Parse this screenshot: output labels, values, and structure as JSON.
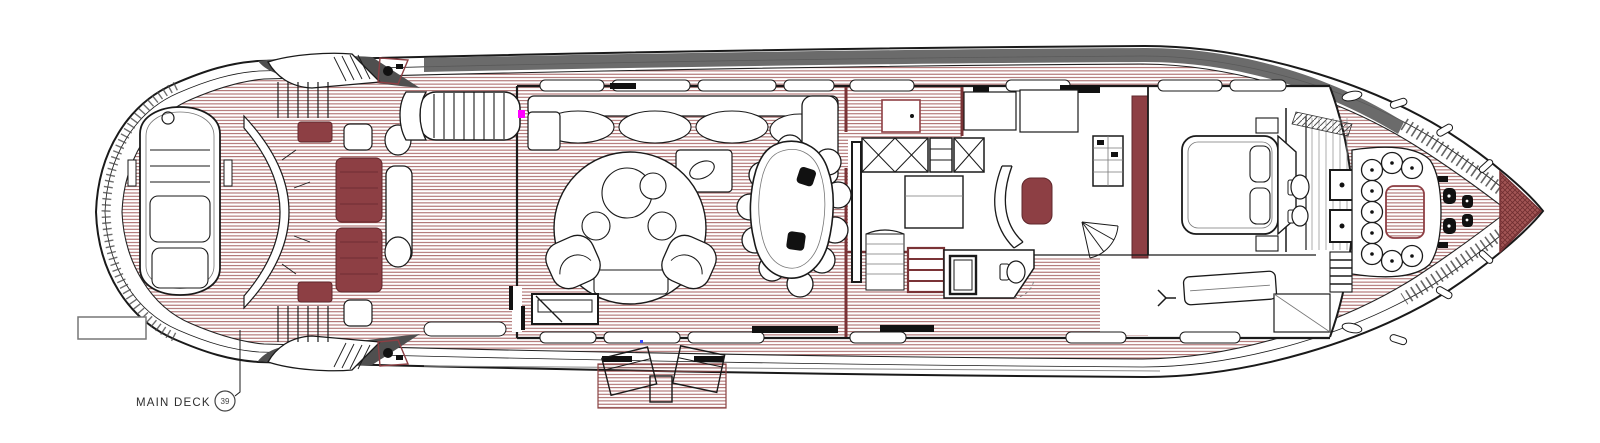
{
  "drawing": {
    "label": {
      "deck_name": "MAIN DECK",
      "sheet_number": "39"
    },
    "colors": {
      "planking_red": "#9b4e4e",
      "furniture_maroon": "#8d3f44",
      "wall_maroon": "#7a3336",
      "outline_black": "#1a1a1a",
      "roof_gray": "#5e5e5e",
      "marker_magenta": "#ff00ff",
      "marker_blue": "#3344ff",
      "label_text": "#2e2e2e"
    }
  }
}
